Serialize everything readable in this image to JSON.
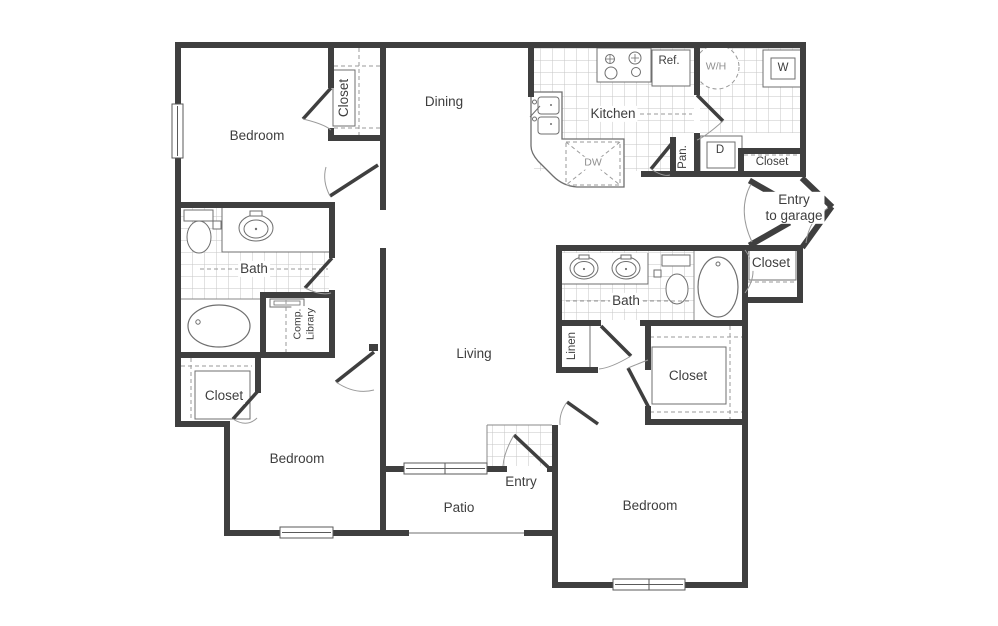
{
  "plan": {
    "rooms": {
      "bedroom_top_left": "Bedroom",
      "closet_top": "Closet",
      "dining": "Dining",
      "kitchen": "Kitchen",
      "bath_left": "Bath",
      "comp_library_line1": "Comp.",
      "comp_library_line2": "Library",
      "closet_left": "Closet",
      "bedroom_bottom_left": "Bedroom",
      "living": "Living",
      "entry": "Entry",
      "patio": "Patio",
      "bedroom_bottom_right": "Bedroom",
      "bath_right": "Bath",
      "linen": "Linen",
      "closet_bottom_right": "Closet",
      "closet_garage": "Closet",
      "closet_utility": "Closet",
      "pantry": "Pan.",
      "entry_garage_line1": "Entry",
      "entry_garage_line2": "to garage"
    },
    "appliances": {
      "refrigerator": "Ref.",
      "water_heater": "W/H",
      "washer": "W",
      "dryer": "D",
      "dishwasher": "DW"
    },
    "colors": {
      "wall": "#3f3f3f",
      "thin_line": "#6f6f6f",
      "tile_line": "#c2c2c2",
      "dashed_line": "#999999",
      "text": "#3e3e3e",
      "muted_text": "#8f8f8f",
      "background": "#ffffff"
    }
  }
}
